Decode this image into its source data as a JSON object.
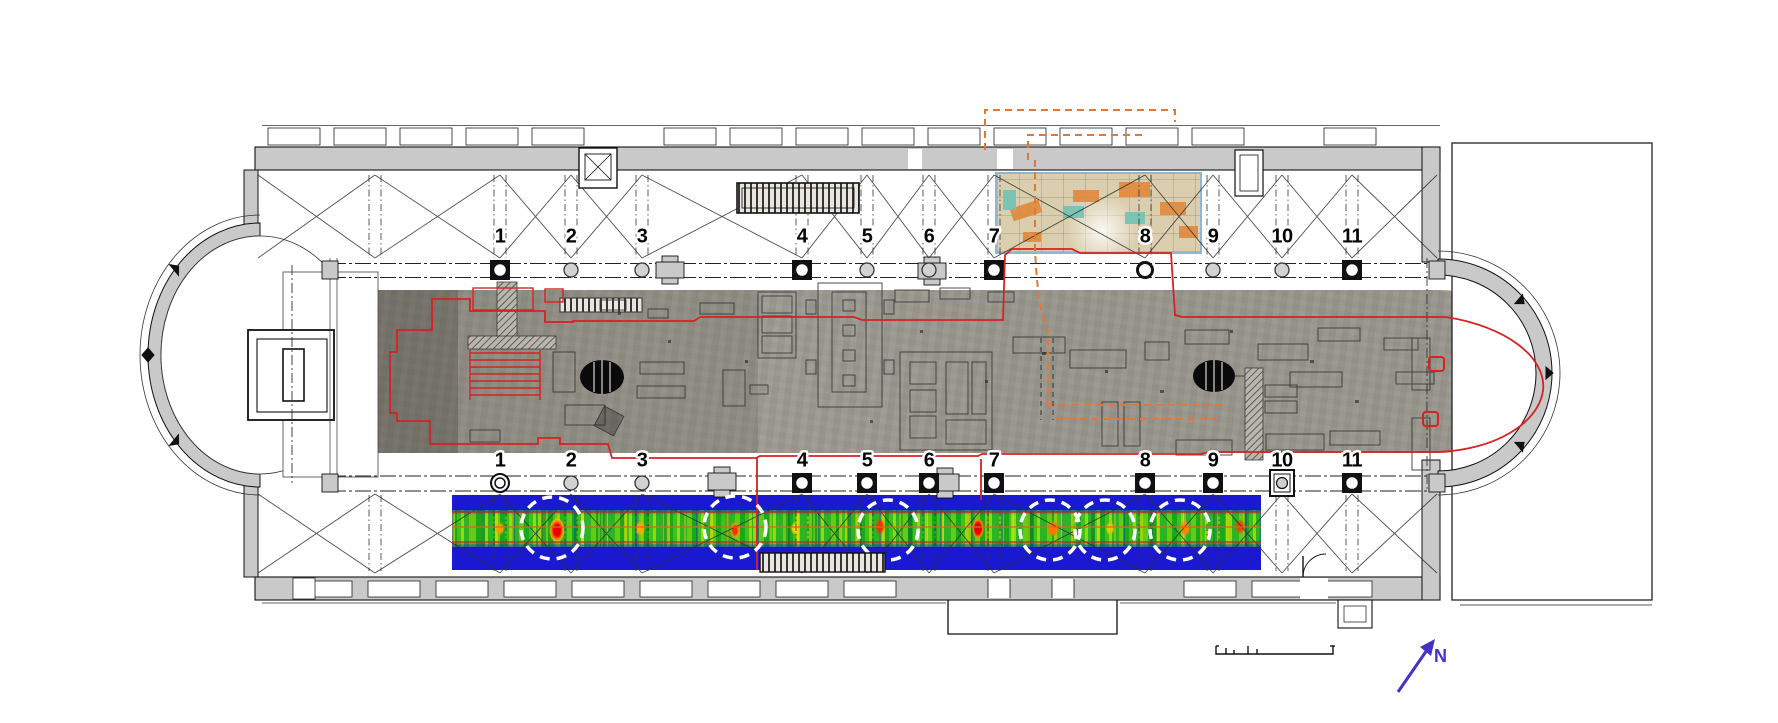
{
  "figure": {
    "type": "church-floor-plan-with-gpr-survey-overlay",
    "background": "#ffffff"
  },
  "colors": {
    "wall_grey": "#c9c9c9",
    "line_black": "#1a1a1a",
    "excavation_outline_red": "#d92121",
    "trench_dashed_orange": "#e07838",
    "heatmap_blue": "#1a18d0",
    "anomaly_circle": "#ffffff",
    "north_blue": "#4331c8",
    "photo_grey": "#99978d",
    "inset_beige": "#dbceae"
  },
  "colonnades": {
    "labels": [
      "1",
      "2",
      "3",
      "4",
      "5",
      "6",
      "7",
      "8",
      "9",
      "10",
      "11"
    ],
    "column_x": [
      500,
      571,
      642,
      802,
      867,
      929,
      994,
      1145,
      1213,
      1282,
      1352
    ],
    "rows": [
      {
        "id": "north",
        "label_y": 237,
        "marker_y": 270,
        "aisle_y1": 175,
        "aisle_y2": 258,
        "markers": [
          "plinth",
          "plain",
          "plain",
          "plinth",
          "plain",
          "plain",
          "plinth",
          "ring",
          "plain",
          "plain",
          "plinth"
        ]
      },
      {
        "id": "south",
        "label_y": 461,
        "marker_y": 483,
        "aisle_y1": 495,
        "aisle_y2": 571,
        "markers": [
          "ring2",
          "plain",
          "plain",
          "plinth",
          "plinth",
          "plinth",
          "plinth",
          "plinth",
          "plinth",
          "box",
          "plinth"
        ]
      }
    ]
  },
  "bays": {
    "pairs": [
      [
        258,
        375
      ],
      [
        375,
        500
      ],
      [
        500,
        571
      ],
      [
        571,
        642
      ],
      [
        642,
        802
      ],
      [
        802,
        867
      ],
      [
        867,
        929
      ],
      [
        929,
        994
      ],
      [
        994,
        1145
      ],
      [
        1145,
        1213
      ],
      [
        1213,
        1282
      ],
      [
        1282,
        1352
      ],
      [
        1352,
        1437
      ]
    ],
    "top_y": [
      175,
      258
    ],
    "bottom_y": [
      494,
      573
    ]
  },
  "gpr": {
    "strip": {
      "x": 452,
      "y": 495,
      "w": 809,
      "h": 75
    },
    "band": {
      "top": 510,
      "bottom": 547
    },
    "anomaly_circles": [
      {
        "x": 552,
        "y": 528,
        "r": 31
      },
      {
        "x": 735,
        "y": 527,
        "r": 31
      },
      {
        "x": 888,
        "y": 530,
        "r": 30
      },
      {
        "x": 1050,
        "y": 530,
        "r": 30
      },
      {
        "x": 1105,
        "y": 530,
        "r": 30
      },
      {
        "x": 1180,
        "y": 530,
        "r": 30
      }
    ],
    "profile_lines": [
      {
        "y": 512,
        "color": "#cc2222"
      },
      {
        "y": 527,
        "color": "#d06a2a"
      },
      {
        "y": 542,
        "color": "#cc2222"
      }
    ],
    "marker_lines": [
      {
        "x": 757,
        "y1": 458,
        "y2": 570
      },
      {
        "x": 981,
        "y1": 459,
        "y2": 500
      }
    ]
  },
  "north_arrow": {
    "label": "N"
  },
  "scale_bar": {
    "present": true,
    "labels_legible": false
  }
}
